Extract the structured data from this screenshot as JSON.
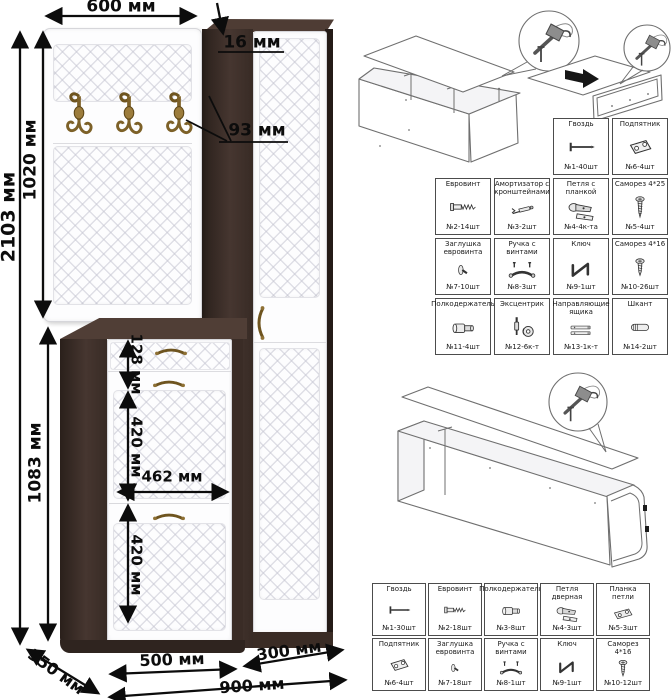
{
  "left_drawing": {
    "dim_panel_width": "600 мм",
    "dim_panel_thickness": "16 мм",
    "dim_hook_offset": "93 мм",
    "dim_total_height": "2103 мм",
    "dim_panel_height": "1020 мм",
    "dim_base_height": "1083 мм",
    "dim_drawer_height": "128 мм",
    "dim_upper_flap_height": "420 мм",
    "dim_inner_width": "462 мм",
    "dim_lower_flap_height": "420 мм",
    "dim_shoe_cabinet_width": "500 мм",
    "dim_tall_cabinet_width": "300 мм",
    "dim_total_width": "900 мм",
    "dim_depth": "350 мм"
  },
  "hardware_table_top": {
    "cells": [
      {
        "name": "Гвоздь",
        "qty": "№1-40шт"
      },
      {
        "name": "Подпятник",
        "qty": "№6-4шт"
      },
      {
        "name": "Евровинт",
        "qty": "№2-14шт"
      },
      {
        "name": "Амортизатор с кронштейнами",
        "qty": "№3-2шт"
      },
      {
        "name": "Петля с планкой",
        "qty": "№4-4к-та"
      },
      {
        "name": "Саморез 4*25",
        "qty": "№5-4шт"
      },
      {
        "name": "Заглушка евровинта",
        "qty": "№7-10шт"
      },
      {
        "name": "Ручка с винтами",
        "qty": "№8-3шт"
      },
      {
        "name": "Ключ",
        "qty": "№9-1шт"
      },
      {
        "name": "Саморез 4*16",
        "qty": "№10-26шт"
      },
      {
        "name": "Полкодержатель",
        "qty": "№11-4шт"
      },
      {
        "name": "Эксцентрик",
        "qty": "№12-6к-т"
      },
      {
        "name": "Направляющие ящика",
        "qty": "№13-1к-т"
      },
      {
        "name": "Шкант",
        "qty": "№14-2шт"
      }
    ]
  },
  "hardware_table_bottom": {
    "cells": [
      {
        "name": "Гвоздь",
        "qty": "№1-30шт"
      },
      {
        "name": "Евровинт",
        "qty": "№2-18шт"
      },
      {
        "name": "Полкодержатель",
        "qty": "№3-8шт"
      },
      {
        "name": "Петля дверная",
        "qty": "№4-3шт"
      },
      {
        "name": "Планка петли",
        "qty": "№5-3шт"
      },
      {
        "name": "Подпятник",
        "qty": "№6-4шт"
      },
      {
        "name": "Заглушка евровинта",
        "qty": "№7-18шт"
      },
      {
        "name": "Ручка с винтами",
        "qty": "№8-1шт"
      },
      {
        "name": "Ключ",
        "qty": "№9-1шт"
      },
      {
        "name": "Саморез 4*16",
        "qty": "№10-12шт"
      }
    ]
  }
}
